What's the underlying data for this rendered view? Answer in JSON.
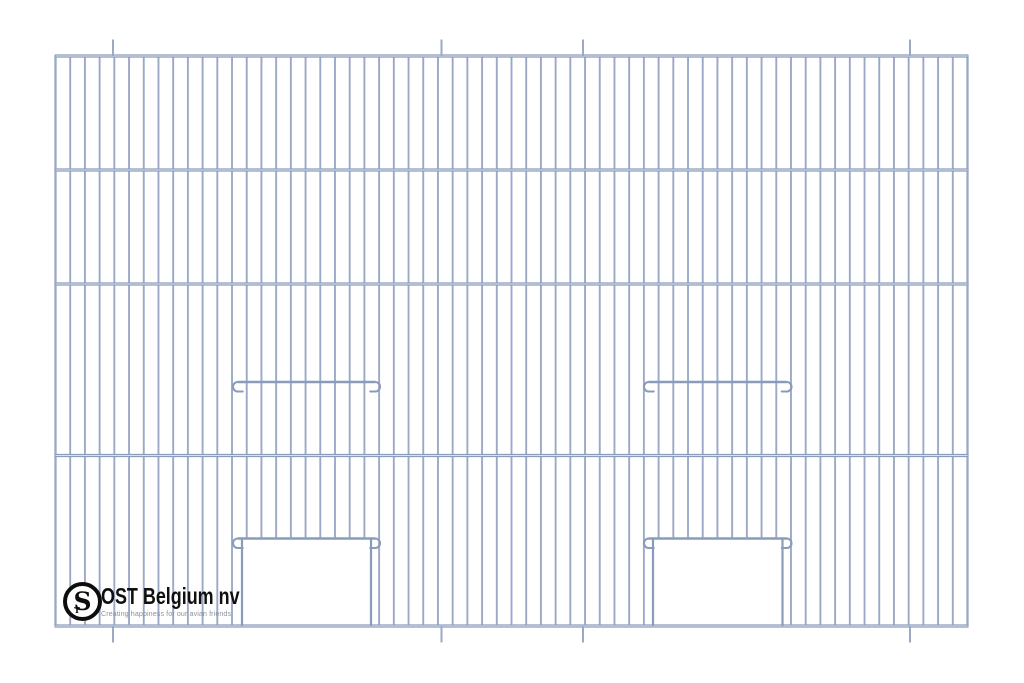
{
  "canvas": {
    "background": "#ffffff"
  },
  "logo": {
    "company_name": "OST Belgium nv",
    "tagline": "Creating happiness for our avian friends",
    "monogram": "S",
    "monogram_small": "T",
    "text_color": "#101010",
    "tagline_color": "#8a93a2"
  },
  "diagram": {
    "type": "diagram",
    "subject": "wire cage front panel with two door openings, door header bars and perch/latch hook bars",
    "colors": {
      "wire": "#9ba9c6",
      "bar": "#8b9cbb",
      "bar_highlight": "#dbe1ec",
      "background": "#ffffff"
    },
    "panel": {
      "left": 55.5,
      "right": 967.5,
      "top": 56,
      "bottom": 626
    },
    "horizontal_bars_y": [
      56,
      170,
      284,
      455.5,
      626
    ],
    "vertical_wire_count": 63,
    "wire_width": 1.9,
    "edge_wire_width": 2.3,
    "bar_width": 3.2,
    "mount_pins_x": [
      113,
      441.5,
      583,
      910
    ],
    "pin_length": 16.5,
    "pin_width": 2,
    "hook_radius": 4.75,
    "hook_tail": 5,
    "hook_overhang": 9,
    "doors": [
      {
        "open_left": 242,
        "open_right": 371,
        "header_y": 538.5,
        "latch_y": 382
      },
      {
        "open_left": 653,
        "open_right": 782.5,
        "header_y": 538.5,
        "latch_y": 382
      }
    ]
  }
}
